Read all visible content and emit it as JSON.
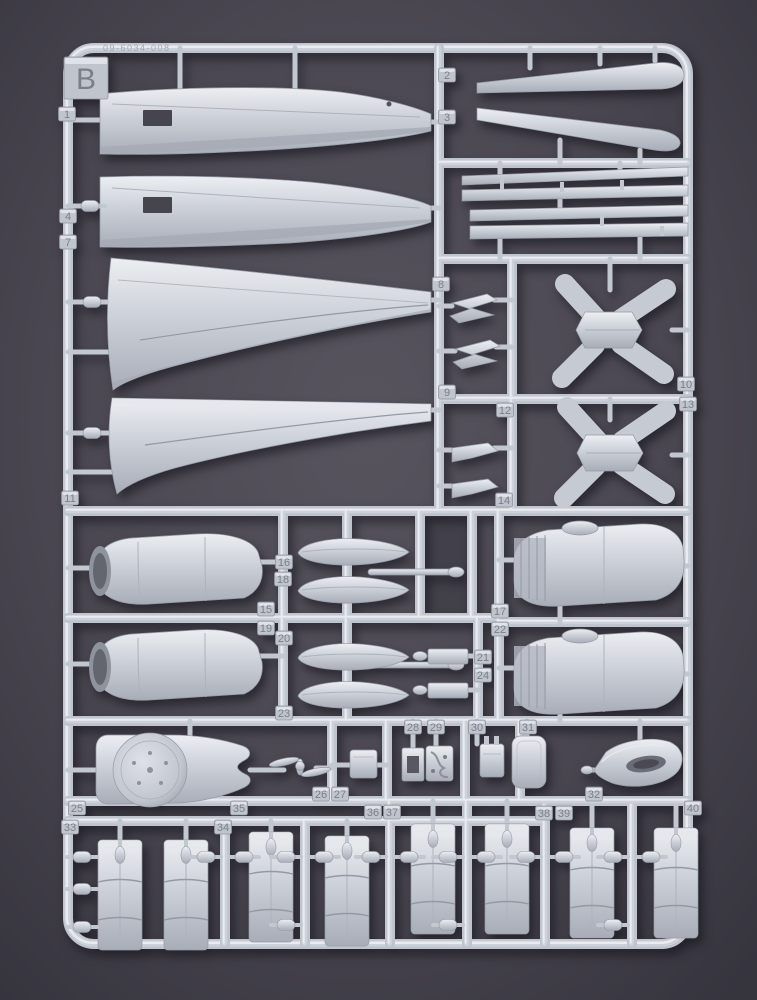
{
  "scene": {
    "type": "plastic-model-kit-sprue-photo",
    "sprue_letter": "B",
    "embossed_code": "09-6034-008"
  },
  "colors": {
    "background_center": "#57545e",
    "background_mid": "#4a4751",
    "background_edge": "#36343d",
    "plastic_base": "#bfc3cd",
    "plastic_mid": "#cdd1d9",
    "plastic_highlight": "#e9ebef",
    "plastic_shadow": "#9ba0ab",
    "hole_dark": "#46444d",
    "tab_fill": "#c0c4cd",
    "tab_number": "#7b7f8a"
  },
  "part_tabs": [
    {
      "label": "B",
      "x": 86,
      "y": 78,
      "size": "large"
    },
    {
      "label": "1",
      "x": 67,
      "y": 114
    },
    {
      "label": "2",
      "x": 447,
      "y": 75
    },
    {
      "label": "3",
      "x": 447,
      "y": 117
    },
    {
      "label": "4",
      "x": 68,
      "y": 216
    },
    {
      "label": "7",
      "x": 68,
      "y": 242
    },
    {
      "label": "8",
      "x": 441,
      "y": 284
    },
    {
      "label": "9",
      "x": 447,
      "y": 392
    },
    {
      "label": "10",
      "x": 686,
      "y": 384
    },
    {
      "label": "11",
      "x": 70,
      "y": 498
    },
    {
      "label": "12",
      "x": 505,
      "y": 410
    },
    {
      "label": "13",
      "x": 688,
      "y": 404
    },
    {
      "label": "14",
      "x": 504,
      "y": 500
    },
    {
      "label": "15",
      "x": 266,
      "y": 609
    },
    {
      "label": "16",
      "x": 284,
      "y": 562
    },
    {
      "label": "17",
      "x": 500,
      "y": 611
    },
    {
      "label": "18",
      "x": 283,
      "y": 579
    },
    {
      "label": "19",
      "x": 266,
      "y": 628
    },
    {
      "label": "20",
      "x": 284,
      "y": 638
    },
    {
      "label": "21",
      "x": 483,
      "y": 657
    },
    {
      "label": "22",
      "x": 500,
      "y": 629
    },
    {
      "label": "23",
      "x": 284,
      "y": 713
    },
    {
      "label": "24",
      "x": 483,
      "y": 675
    },
    {
      "label": "25",
      "x": 77,
      "y": 808
    },
    {
      "label": "26",
      "x": 321,
      "y": 794
    },
    {
      "label": "27",
      "x": 340,
      "y": 794
    },
    {
      "label": "28",
      "x": 413,
      "y": 727
    },
    {
      "label": "29",
      "x": 436,
      "y": 727
    },
    {
      "label": "30",
      "x": 477,
      "y": 727
    },
    {
      "label": "31",
      "x": 528,
      "y": 727
    },
    {
      "label": "32",
      "x": 594,
      "y": 794
    },
    {
      "label": "33",
      "x": 70,
      "y": 827
    },
    {
      "label": "34",
      "x": 223,
      "y": 827
    },
    {
      "label": "35",
      "x": 239,
      "y": 808
    },
    {
      "label": "36",
      "x": 373,
      "y": 812
    },
    {
      "label": "37",
      "x": 392,
      "y": 812
    },
    {
      "label": "38",
      "x": 544,
      "y": 813
    },
    {
      "label": "39",
      "x": 564,
      "y": 813
    },
    {
      "label": "40",
      "x": 693,
      "y": 808
    }
  ]
}
